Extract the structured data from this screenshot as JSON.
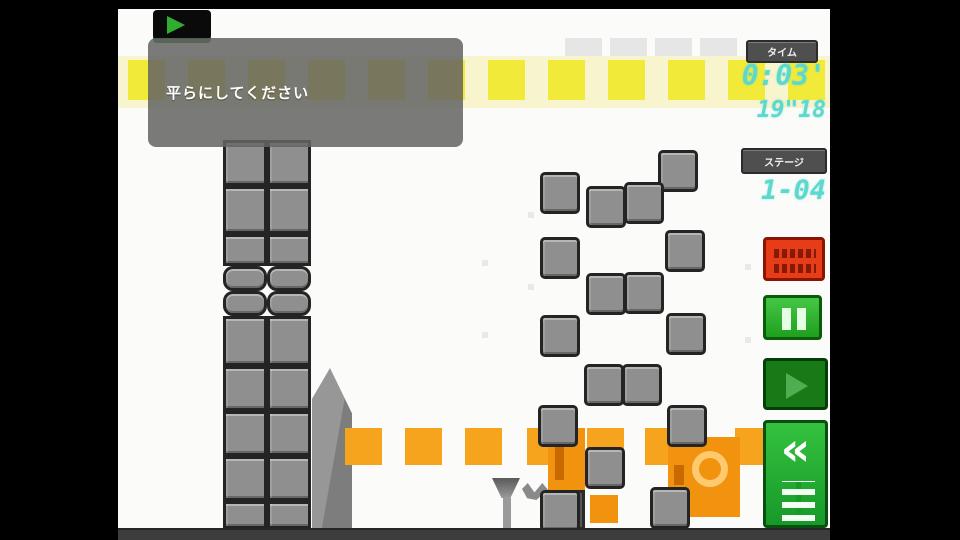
{
  "tooltip": {
    "text": "平らにしてください"
  },
  "hud": {
    "time_label": "タイム",
    "time_main": "0:03'",
    "time_sub": "19\"18",
    "stage_label": "ステージ",
    "stage_value": "1-04"
  },
  "buttons": {
    "playback_icon": "play-triangle",
    "reset_icon": "red-text-marks",
    "pause_icon": "pause-bars",
    "play_icon": "play-triangle",
    "rewind_chevron": "«",
    "rewind_icon": "kanji-grid"
  },
  "colors": {
    "yellow_square": "#f2ea38",
    "orange_square": "#f6a41e",
    "digital_cyan": "#5cd9cf",
    "button_green": "#1fb32c",
    "button_red": "#e63c17",
    "block_gray": "#8f8f8f"
  },
  "scene": {
    "bg_dots": [
      [
        364,
        251
      ],
      [
        364,
        323
      ],
      [
        627,
        255
      ],
      [
        627,
        328
      ],
      [
        410,
        203
      ],
      [
        410,
        275
      ]
    ],
    "yellow_row": {
      "band_y": 47,
      "band_h": 52,
      "y": 51,
      "w": 37,
      "h": 40,
      "xs": [
        10,
        70,
        130,
        190,
        250,
        310,
        370,
        430,
        490,
        550,
        610,
        670
      ]
    },
    "hint_row": {
      "y": 29,
      "h": 18,
      "w": 37,
      "xs": [
        447,
        492,
        537,
        582
      ]
    },
    "tower": {
      "cols": [
        105,
        149
      ],
      "w": 44,
      "rows": [
        {
          "y": 131,
          "h": 46
        },
        {
          "y": 177,
          "h": 48
        },
        {
          "y": 225,
          "h": 32
        },
        {
          "y": 257,
          "h": 25,
          "r": 1
        },
        {
          "y": 282,
          "h": 25,
          "r": 1
        },
        {
          "y": 307,
          "h": 50
        },
        {
          "y": 357,
          "h": 45
        },
        {
          "y": 402,
          "h": 45
        },
        {
          "y": 447,
          "h": 45
        },
        {
          "y": 492,
          "h": 28
        }
      ]
    },
    "orange_row": {
      "y": 419,
      "w": 37,
      "h": 37,
      "xs": [
        227,
        287,
        347,
        409,
        469,
        527,
        617
      ]
    },
    "rects": [
      {
        "c": "ramp",
        "n": "ramp-wedge",
        "i": true,
        "x": 194,
        "y": 359,
        "w": 40,
        "h": 162
      },
      {
        "c": "orange-col",
        "n": "orange-column-block",
        "i": true,
        "x": 430,
        "y": 419,
        "w": 37,
        "h": 62
      },
      {
        "c": "dark-block",
        "n": "dark-green-block",
        "i": true,
        "x": 430,
        "y": 481,
        "w": 37,
        "h": 40
      },
      {
        "c": "orange-target",
        "n": "orange-target-block",
        "i": true,
        "x": 550,
        "y": 428,
        "w": 72,
        "h": 80
      },
      {
        "c": "orange-sm",
        "n": "orange-small-block",
        "i": true,
        "x": 472,
        "y": 486,
        "w": 28,
        "h": 28
      },
      {
        "c": "pin-top",
        "n": "pin-stand-top",
        "i": false,
        "x": 374,
        "y": 469,
        "w": 28,
        "h": 20
      },
      {
        "c": "pin-stem",
        "n": "pin-stand-stem",
        "i": false,
        "x": 385,
        "y": 489,
        "w": 8,
        "h": 33
      },
      {
        "c": "wing",
        "n": "debris-mark",
        "i": false,
        "x": 404,
        "y": 474,
        "w": 26,
        "h": 17
      }
    ],
    "ladder": {
      "w": 40,
      "h": 42,
      "positions": [
        [
          540,
          141
        ],
        [
          422,
          163
        ],
        [
          468,
          177
        ],
        [
          506,
          173
        ],
        [
          422,
          228
        ],
        [
          547,
          221
        ],
        [
          468,
          264
        ],
        [
          506,
          263
        ],
        [
          422,
          306
        ],
        [
          548,
          304
        ],
        [
          466,
          355
        ],
        [
          504,
          355
        ],
        [
          420,
          396
        ],
        [
          549,
          396
        ],
        [
          467,
          438
        ],
        [
          422,
          481
        ],
        [
          532,
          478
        ]
      ]
    }
  }
}
